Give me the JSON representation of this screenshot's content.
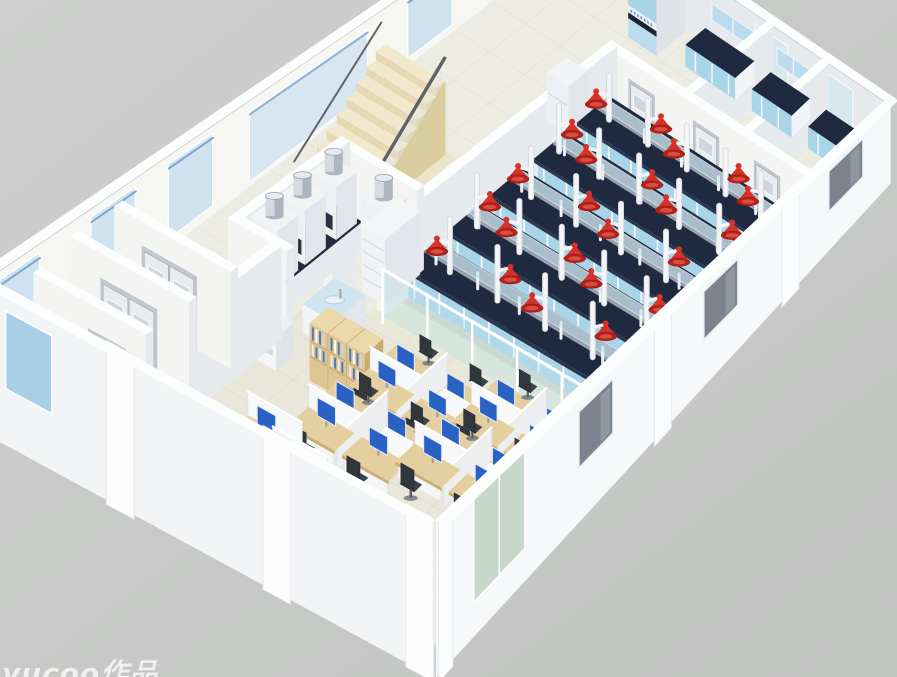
{
  "watermark": {
    "text": "yucoo作品"
  },
  "scene": {
    "corners": {
      "N": [
        565,
        -55
      ],
      "E": [
        890,
        165
      ],
      "S": [
        435,
        645
      ],
      "W": [
        -25,
        395
      ]
    },
    "grid": {
      "A": 10,
      "B": 16
    },
    "heights": {
      "wall": 86,
      "extWall": 100,
      "bench": 30,
      "partition": 30,
      "door": 62,
      "desk": 13,
      "step_rise": 9.5,
      "step_base": 6
    },
    "palette": {
      "bg1": "#cdcecd",
      "bg2": "#c2c4c2",
      "floor": "#edece3",
      "floorLab": "#e7e8d6",
      "floorOffice": "#e9e7d9",
      "floorStair": "#ece4c8",
      "wallFace": "#f4f5f3",
      "wallSide": "#e7eaec",
      "wallTop": "#fcfdfd",
      "wallExtSE": "#f6f8fa",
      "wallExtSW": "#f2f4f6",
      "glass": "#cfe2f0",
      "glassBlue": "#a9cfe7",
      "glassGray": "#7d838c",
      "glassGreen": "#c6d6c9",
      "glassTeal": "#bfe3ea",
      "benchTop": "#1f2940",
      "benchEdge": "#2a3550",
      "benchFront": "#a9d5e9",
      "benchSide": "#f2f5f7",
      "benchLine": "#f2f7fa",
      "shelfGlass": "#cfe9f2",
      "pole": "#f2f4f6",
      "poleEdge": "#d7dbe0",
      "red": "#d5332a",
      "redDark": "#b3211a",
      "redRim": "#8e140e",
      "wood": "#dfc591",
      "woodSide": "#c8ab72",
      "woodTop": "#ecd9ab",
      "deskWood": "#e4cfa0",
      "deskEdge": "#c9ad74",
      "part": "#f7f8f9",
      "chairSeat": "#3e434b",
      "chairBack": "#32373e",
      "monitor": "#2a62c4",
      "metal1": "#d6dae0",
      "metal2": "#aeb5bf",
      "metal3": "#e8ebee",
      "counterDark": "#232c3e",
      "door": "#e9ecef",
      "doorFrame": "#c3c8cf",
      "doorWin": "#cfd7de",
      "stepTop": "#f2e9cd",
      "stepFront": "#e5d8b2",
      "stepSide": "#d9cc9e",
      "rail": "#606468",
      "cabBlue": "#a8d2e8",
      "cabBlueLow": "#bcdcee",
      "opening": "#1c2433",
      "bookBlue": "#4a79c4"
    },
    "floorZones": [
      {
        "r": [
          4.05,
          2.6,
          10,
          9.75
        ],
        "fill": "#e7e8d6"
      },
      {
        "r": [
          2.95,
          9.75,
          10,
          16
        ],
        "fill": "#e9e7d9"
      },
      {
        "r": [
          0.45,
          5.5,
          2.55,
          8.1
        ],
        "fill": "#ece4c8"
      }
    ],
    "nwWall": {
      "windows": [
        [
          0.6,
          1.8
        ],
        [
          3.1,
          4.3
        ],
        [
          9.6,
          10.8
        ],
        [
          11.7,
          12.9
        ],
        [
          14.3,
          15.5
        ]
      ],
      "stairGlass": [
        5.4,
        8.6
      ]
    },
    "neWall": {
      "glass": [
        [
          5.9,
          6.9
        ],
        [
          7.9,
          8.9
        ]
      ],
      "upperCabinets": [
        [
          4.6,
          5.9
        ],
        [
          6.6,
          7.6
        ]
      ]
    },
    "seWall": {
      "windows": [
        [
          1.0,
          2.2
        ],
        [
          5.4,
          6.6
        ],
        [
          9.8,
          11.0
        ]
      ],
      "glassGreen": [
        12.9,
        14.7
      ],
      "pilasters": [
        [
          3.3,
          3.9
        ],
        [
          7.8,
          8.4
        ],
        [
          15.5,
          16
        ]
      ]
    },
    "swWall": {
      "windowBlue": [
        0.7,
        1.7
      ],
      "pilasters": [
        [
          2.9,
          3.5
        ],
        [
          6.3,
          6.9
        ],
        [
          9.4,
          10.0
        ]
      ]
    },
    "stairs": {
      "u1": 0.7,
      "u2": 2.3,
      "vStart": 8.0,
      "steps": 9,
      "depth": 0.27
    },
    "corridorWall": {
      "u": 4.05,
      "segs": [
        [
          2.6,
          9.55
        ],
        [
          10.45,
          11.15
        ]
      ]
    },
    "backRooms": {
      "wallsV": [
        {
          "u": 6.2,
          "v1": 0,
          "v2": 2.55
        },
        {
          "u": 7.9,
          "v1": 0,
          "v2": 2.55
        }
      ],
      "wallU": {
        "v": 2.55,
        "u1": 4.05,
        "u2": 10
      },
      "doors": [
        {
          "u": 5.15,
          "w": 0.62
        },
        {
          "u": 7.0,
          "w": 0.62
        },
        {
          "u": 8.75,
          "w": 0.62
        }
      ],
      "benches": [
        [
          4.5,
          0.18,
          6.0,
          0.78
        ],
        [
          6.5,
          0.18,
          7.7,
          0.78
        ],
        [
          8.2,
          0.18,
          9.7,
          0.78
        ]
      ],
      "sideBenches": [
        [
          9.52,
          1.0,
          9.95,
          2.3
        ],
        [
          9.52,
          3.15,
          9.95,
          4.45
        ]
      ],
      "tallCabinet": {
        "u": 2.95,
        "v": 0.1,
        "w": 0.85,
        "d": 0.85,
        "h": 96
      }
    },
    "labBenches": {
      "u1": 4.3,
      "u2": 9.55,
      "halfW": 0.41,
      "rows": [
        {
          "v": 3.3,
          "cones": [
            4.7,
            5.8,
            6.9,
            8.0,
            9.0
          ]
        },
        {
          "v": 4.6,
          "cones": [
            4.5,
            5.6,
            6.7,
            7.8,
            8.9
          ]
        },
        {
          "v": 5.9,
          "cones": [
            4.9,
            6.1,
            7.3,
            8.5
          ]
        },
        {
          "v": 7.2,
          "cones": [
            4.6,
            5.7,
            6.8,
            7.9,
            9.0
          ]
        },
        {
          "v": 8.5,
          "cones": [
            5.0,
            6.2,
            7.4,
            8.6
          ]
        }
      ]
    },
    "fridge": [
      3.25,
      3.05,
      3.85,
      3.62
    ],
    "fumeRoom": {
      "wallBack": {
        "v": 8.15,
        "u1": 1.95,
        "u2": 4.05
      },
      "wallLeft": {
        "u": 1.95,
        "v1": 8.15,
        "v2": 11.15
      },
      "wallFront": {
        "v": 11.15,
        "u1": 1.95,
        "u2": 3.35
      },
      "counter": [
        2.0,
        8.45,
        2.75,
        10.85
      ],
      "hoods": [
        [
          2.06,
          8.55,
          2.7,
          9.15
        ],
        [
          2.06,
          9.45,
          2.7,
          10.05
        ],
        [
          2.06,
          10.25,
          2.7,
          10.85
        ]
      ],
      "hoodTall": [
        3.1,
        8.3,
        3.75,
        8.9
      ],
      "cylinders": [
        [
          2.38,
          8.85,
          78
        ],
        [
          2.38,
          9.75,
          78
        ],
        [
          2.38,
          10.55,
          78
        ],
        [
          3.42,
          8.6,
          70
        ]
      ],
      "shelf": [
        3.5,
        8.3,
        4.08,
        9.35
      ],
      "sink": [
        3.35,
        9.95,
        4.1,
        10.9
      ]
    },
    "glassWall": {
      "v": 9.75,
      "u1": 4.35,
      "u2": 9.9
    },
    "bookshelf": {
      "u": 4.25,
      "v": 11.25,
      "n": 3,
      "w": 0.42,
      "d": 0.57,
      "h": 52
    },
    "copier": [
      3.05,
      11.5,
      3.62,
      12.02
    ],
    "pods": [
      [
        6.3,
        11.05
      ],
      [
        8.35,
        10.55
      ],
      [
        6.05,
        12.6
      ],
      [
        8.15,
        12.1
      ]
    ],
    "wallDesks": [
      [
        4.75,
        13.9
      ],
      [
        5.65,
        14.35
      ],
      [
        6.6,
        14.8
      ]
    ],
    "doorRooms": {
      "wallsU": [
        {
          "v": 12.3,
          "u1": 0.25,
          "u2": 2.95,
          "door": {
            "u": 1.55,
            "w": 1.15,
            "dbl": true
          }
        },
        {
          "v": 13.5,
          "u1": 0.25,
          "u2": 2.95,
          "door": {
            "u": 1.6,
            "w": 1.15,
            "dbl": true
          }
        },
        {
          "v": 14.75,
          "u1": 0.45,
          "u2": 2.95,
          "door": {
            "u": 2.1,
            "w": 0.7,
            "dbl": false
          }
        }
      ],
      "wallV": {
        "u": 2.95,
        "v1": 11.3,
        "v2": 15.1
      }
    },
    "reception": {
      "desk": [
        3.25,
        14.8,
        4.4,
        15.5
      ],
      "chair": [
        3.1,
        14.45
      ],
      "phone": [
        3.9,
        15.0
      ],
      "tower": [
        4.18,
        15.3
      ]
    }
  }
}
